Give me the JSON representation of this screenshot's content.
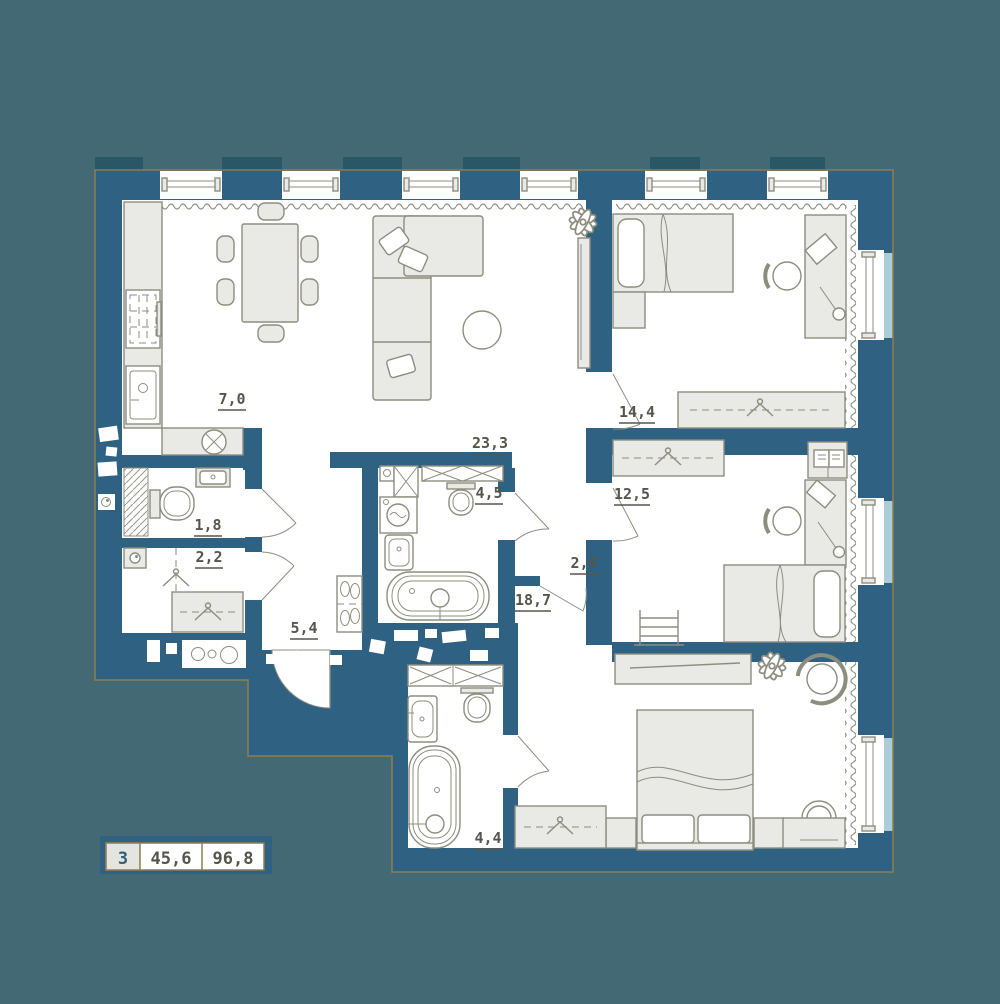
{
  "floorplan": {
    "title": "3-room apartment floor plan",
    "legend": {
      "rooms_count": "3",
      "living_area": "45,6",
      "total_area": "96,8"
    },
    "rooms": {
      "kitchen": "7,0",
      "living_room": "23,3",
      "bedroom_top": "14,4",
      "bedroom_middle": "12,5",
      "bedroom_master": "18,7",
      "hallway": "5,4",
      "corridor": "2,6",
      "wc": "1,8",
      "closet": "2,2",
      "bathroom_top": "4,5",
      "bathroom_bottom": "4,4"
    },
    "colors": {
      "background": "#426974",
      "wall": "#2f6282",
      "wall_dark": "#2a5766",
      "floor": "#ffffff",
      "furniture": "#e9e9e6",
      "furniture_stroke": "#8d8d7f",
      "outline": "#8f7d50",
      "label": "#55564a",
      "sill": "#abcdd8",
      "legend_cell": "#e4e4e1",
      "legend_number": "#2f5f73"
    }
  }
}
